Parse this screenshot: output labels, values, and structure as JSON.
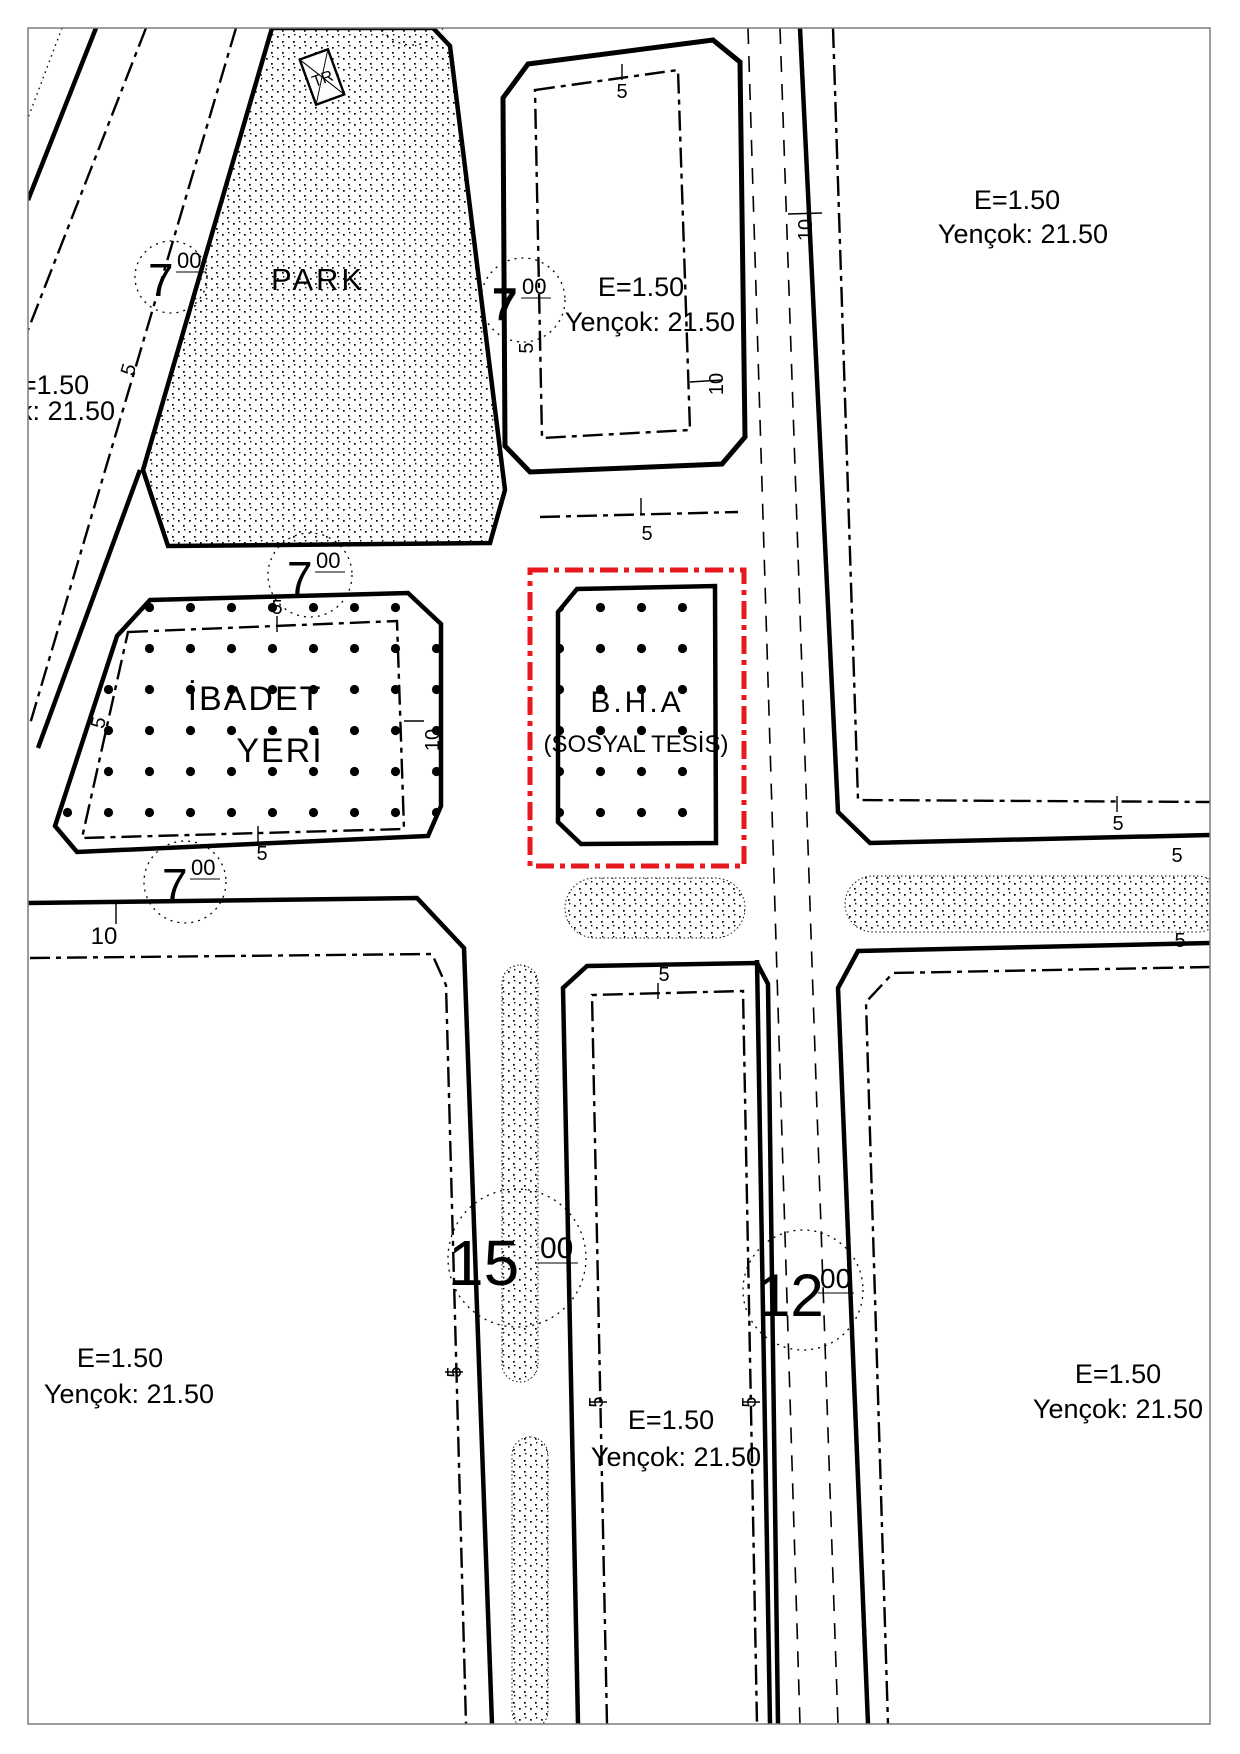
{
  "zones": {
    "park": {
      "label": "PARK"
    },
    "ibadet_yeri": {
      "line1": "İBADET",
      "line2": "YERİ"
    },
    "bha": {
      "label": "B.H.A",
      "sublabel": "(SOSYAL TESİS)"
    },
    "trafo": {
      "label": "TR"
    }
  },
  "zoning_notes": {
    "top_right": {
      "e": "E=1.50",
      "yencok": "Yençok: 21.50"
    },
    "top_middle": {
      "e": "E=1.50",
      "yencok": "Yençok: 21.50"
    },
    "left_edge": {
      "e": "E=1.50",
      "yencok": "Yençok: 21.50"
    },
    "bottom_left": {
      "e": "E=1.50",
      "yencok": "Yençok: 21.50"
    },
    "bottom_middle": {
      "e": "E=1.50",
      "yencok": "Yençok: 21.50"
    },
    "bottom_right": {
      "e": "E=1.50",
      "yencok": "Yençok: 21.50"
    }
  },
  "road_width_markers": [
    {
      "id": "road-7-northwest",
      "value": "7",
      "decimals": "00"
    },
    {
      "id": "road-7-park-east",
      "value": "7",
      "decimals": "00"
    },
    {
      "id": "road-7-park-south",
      "value": "7",
      "decimals": "00"
    },
    {
      "id": "road-7-ibadet-south",
      "value": "7",
      "decimals": "00"
    },
    {
      "id": "road-15",
      "value": "15",
      "decimals": "00"
    },
    {
      "id": "road-12",
      "value": "12",
      "decimals": "00"
    }
  ],
  "dimension_labels": {
    "setback": "5",
    "offset_ten": "10"
  },
  "colors": {
    "line": "#000000",
    "special_boundary_red": "#e8191c",
    "frame": "#7d7d7d"
  }
}
